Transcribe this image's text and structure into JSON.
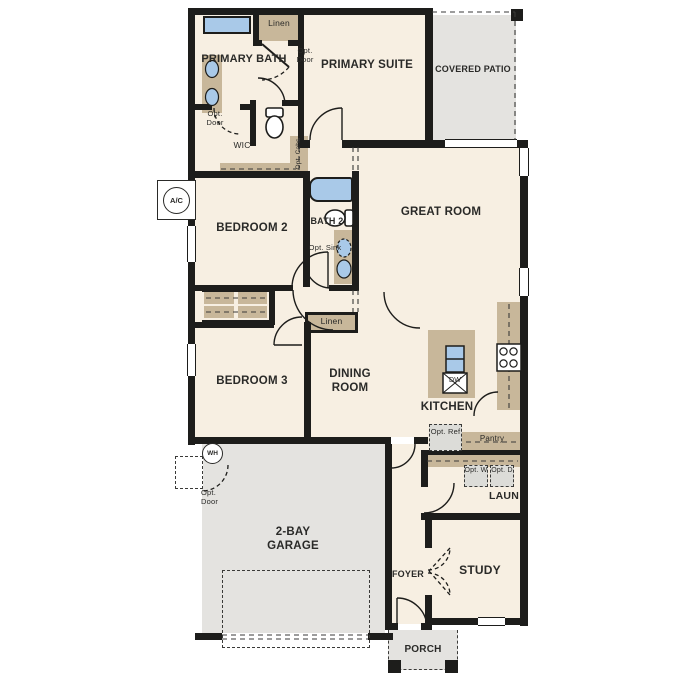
{
  "title": "Single-story floor plan",
  "colors": {
    "floor": "#f7efe2",
    "wall": "#1d1d1b",
    "cabinet": "#c8b79a",
    "fixture_blue": "#a9c9e8",
    "outdoor_gray": "#e4e3e0"
  },
  "rooms": {
    "primary_bath": "PRIMARY BATH",
    "primary_suite": "PRIMARY SUITE",
    "covered_patio": "COVERED PATIO",
    "wic": "WIC",
    "bedroom2": "BEDROOM 2",
    "bath2": "BATH 2",
    "great_room": "GREAT ROOM",
    "bedroom3": "BEDROOM 3",
    "dining_room": "DINING ROOM",
    "kitchen": "KITCHEN",
    "laundry": "LAUN",
    "pantry": "Pantry",
    "garage": "2-BAY GARAGE",
    "foyer": "FOYER",
    "study": "STUDY",
    "porch": "PORCH"
  },
  "features": {
    "linen_upper": "Linen",
    "linen_hall": "Linen",
    "opt_door_suite": "Opt. Door",
    "opt_door_wic": "Opt. Door",
    "opt_door_garage": "Opt. Door",
    "opt_cabs": "Opt. Cabs",
    "opt_sink": "Opt. Sink",
    "opt_ref": "Opt. Ref",
    "opt_washer": "Opt. W",
    "opt_dryer": "Opt. D",
    "dishwasher": "DW",
    "water_heater": "WH",
    "ac_unit": "A/C"
  }
}
